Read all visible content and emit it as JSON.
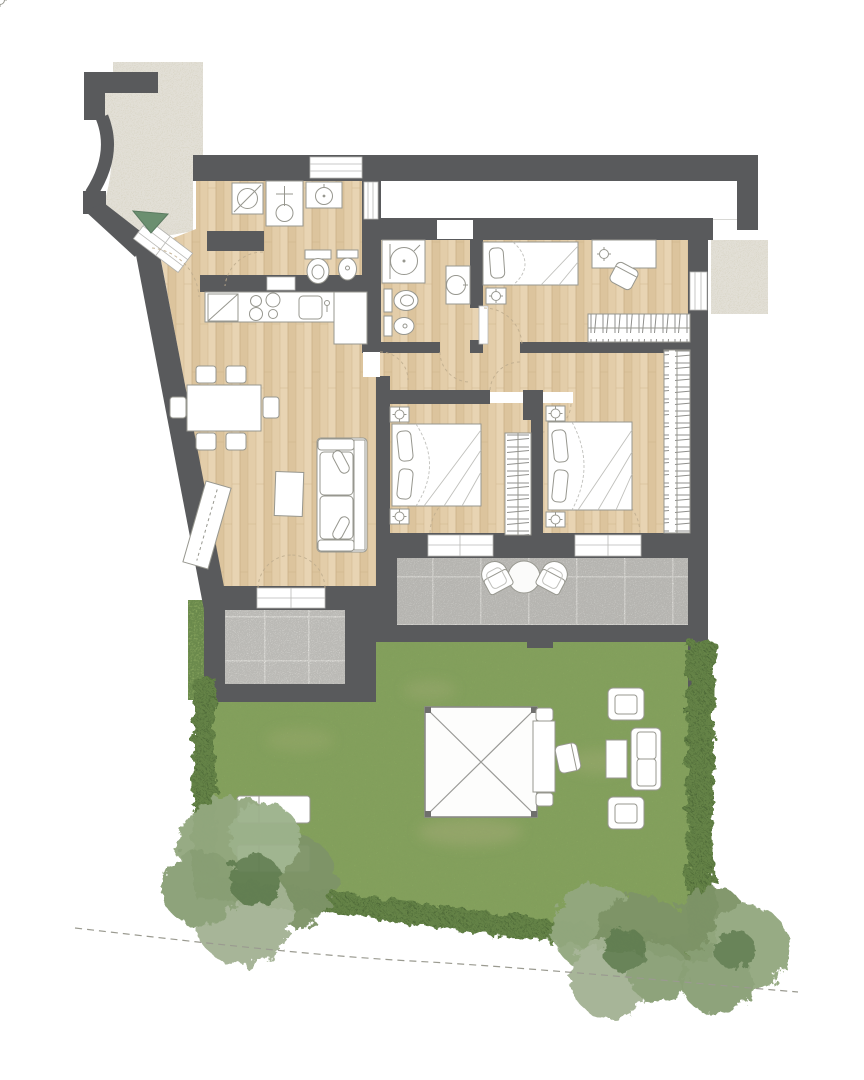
{
  "meta": {
    "kind": "architectural-floor-plan",
    "view": "top-down-render",
    "text_labels": []
  },
  "palette": {
    "background": "#ffffff",
    "wall": "#595a5c",
    "wood": "#e3cda9",
    "wood_dark": "#dcc49d",
    "wood_light": "#e8d4b3",
    "stone": "#dbd7c8",
    "tile_main": "#c5c4c0",
    "tile_small": "#cdccc8",
    "grout": "#eceae6",
    "grass": "#86a35e",
    "grass_dark": "#50703a",
    "grass_light": "#a9c276",
    "hedge": "#4d6837",
    "hedge_light": "#6f8f4e",
    "tree_base": "#93a87f",
    "tree_mid": "#7e9468",
    "tree_light": "#a4b394",
    "tree_dark": "#647f52",
    "furniture_fill": "#ffffff",
    "furniture_stroke": "#97978f",
    "sketch_line": "#c0c0bc",
    "door_arc": "#c0ae8f",
    "entry_arrow": "#6b8f70",
    "boundary_line": "#9a9a90"
  },
  "rooms": {
    "entrance_path": "stone-paved-entrance",
    "hall": "entrance-hall",
    "bathroom_1": "bathroom-laundry",
    "bathroom_2": "bathroom-shower",
    "kitchen_living": "kitchen-dining-living",
    "corridor": "corridor",
    "bedroom_1": "double-bedroom-left",
    "bedroom_2": "double-bedroom-right",
    "bedroom_3": "single-bedroom",
    "terrace_small": "small-terrace",
    "terrace_main": "main-terrace",
    "garden": "private-garden"
  },
  "fixtures": {
    "bathroom_1": [
      "washing-machine",
      "shower",
      "washbasin",
      "toilet",
      "bidet",
      "window"
    ],
    "bathroom_2": [
      "shower",
      "toilet",
      "bidet",
      "washbasin"
    ],
    "kitchen": [
      "fridge",
      "cooktop-4-burners",
      "sink",
      "counter"
    ],
    "dining": [
      "table",
      "chairs-x6"
    ],
    "living": [
      "sofa-2-seat",
      "coffee-table",
      "sideboard",
      "french-door"
    ],
    "bedroom_1": [
      "double-bed",
      "nightstand-x2",
      "lamp-x2",
      "wardrobe",
      "terrace-door"
    ],
    "bedroom_2": [
      "double-bed",
      "nightstand-x2",
      "lamp-x2",
      "wardrobe",
      "terrace-door"
    ],
    "bedroom_3": [
      "single-bed",
      "nightstand",
      "desk",
      "desk-lamp",
      "chair",
      "wardrobe",
      "window"
    ],
    "terrace_main": [
      "armchair-x2",
      "round-table"
    ],
    "garden": [
      "gazebo",
      "garden-table",
      "garden-chairs-x3",
      "lounge-armchair-x2",
      "lounge-sofa",
      "lounge-coffee-table",
      "sun-lounger-x2",
      "tree-x3",
      "hedge"
    ]
  },
  "counts": {
    "trees": 3,
    "sun_loungers": 2,
    "terrace_chairs": 2,
    "dining_chairs": 6,
    "bedrooms": 3,
    "bathrooms": 2
  },
  "symbols": {
    "entry_marker": "green-triangle-arrow",
    "property_boundary": "dashed-line",
    "door_swing": "dashed-quarter-arc"
  }
}
